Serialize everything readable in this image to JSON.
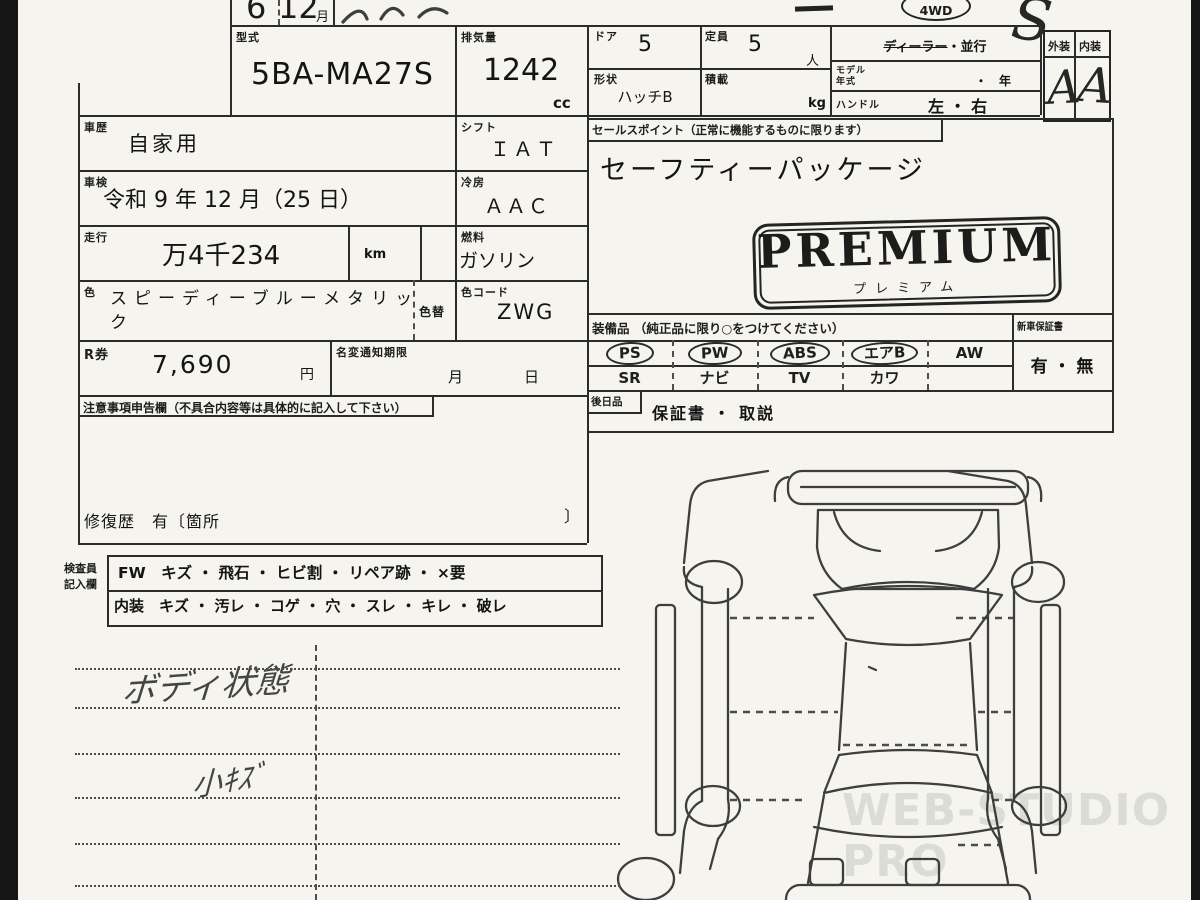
{
  "watermark": "WEB-STUDIO PRO",
  "top_row": {
    "month_num_1": "6",
    "month_num_2": "12",
    "month_unit": "月",
    "drive_type": "4WD",
    "handwritten_grade": "S"
  },
  "header": {
    "model_code": {
      "label": "型式",
      "value": "5BA-MA27S"
    },
    "displacement": {
      "label": "排気量",
      "value": "1242",
      "unit": "cc"
    },
    "doors": {
      "label": "ドア",
      "value": "5"
    },
    "body_shape": {
      "label": "形状",
      "value": "ハッチB"
    },
    "capacity": {
      "label": "定員",
      "value": "5",
      "unit": "人"
    },
    "load": {
      "label": "積載",
      "unit": "kg"
    },
    "dealer_parallel": {
      "option_1": "ディーラー",
      "separator": "・",
      "option_2": "並行"
    },
    "model_year": {
      "label_line1": "モデル",
      "label_line2": "年式",
      "suffix": "・　年"
    },
    "steering": {
      "label": "ハンドル",
      "value": "左 ・ 右"
    },
    "exterior": {
      "label": "外装",
      "grade": "A"
    },
    "interior": {
      "label": "内装",
      "grade": "A"
    }
  },
  "details": {
    "history": {
      "label": "車歴",
      "value": "自家用"
    },
    "shift": {
      "label": "シフト",
      "value": "ＩＡＴ"
    },
    "inspection": {
      "label": "車検",
      "value": "令和 9 年 12 月（25 日）"
    },
    "aircon": {
      "label": "冷房",
      "value": "ＡＡＣ"
    },
    "mileage": {
      "label": "走行",
      "value": "万4千234",
      "unit": "km"
    },
    "fuel": {
      "label": "燃料",
      "value": "ガソリン"
    },
    "color": {
      "label": "色",
      "value": "スピーディーブルーメタリック"
    },
    "color_change": {
      "label": "色替"
    },
    "color_code": {
      "label": "色コード",
      "value": "ZWG"
    },
    "r_ticket": {
      "label": "R券",
      "value": "7,690",
      "unit": "円"
    },
    "name_change_deadline": {
      "label": "名変通知期限",
      "value": "月　　　日"
    },
    "notice": {
      "label": "注意事項申告欄（不具合内容等は具体的に記入して下さい）"
    },
    "repair_history": {
      "text": "修復歴　有〔箇所",
      "bracket": "〕"
    },
    "inspector_box": {
      "label_line1": "検査員",
      "label_line2": "記入欄",
      "fw_row": "FW　キズ ・ 飛石 ・ ヒビ割 ・ リペア跡 ・ ×要",
      "interior_row": "内装　キズ ・ 汚レ ・ コゲ ・ 穴 ・ スレ ・ キレ ・ 破レ"
    },
    "handwritten_notes": [
      {
        "text": "ボディ状態"
      },
      {
        "text": "小ｷｽﾞ"
      }
    ]
  },
  "sales": {
    "sales_point": {
      "label": "セールスポイント（正常に機能するものに限ります）",
      "value": "セーフティーパッケージ"
    },
    "stamp": {
      "title": "PREMIUM",
      "subtitle": "プレミアム"
    },
    "equipment": {
      "label": "装備品 （純正品に限り○をつけてください）",
      "row1": [
        {
          "label": "PS",
          "circled": true
        },
        {
          "label": "PW",
          "circled": true
        },
        {
          "label": "ABS",
          "circled": true
        },
        {
          "label": "エアB",
          "circled": true
        },
        {
          "label": "AW",
          "circled": false
        }
      ],
      "row2": [
        {
          "label": "SR",
          "circled": false
        },
        {
          "label": "ナビ",
          "circled": false
        },
        {
          "label": "TV",
          "circled": false
        },
        {
          "label": "カワ",
          "circled": false
        },
        {
          "label": "",
          "circled": false
        }
      ],
      "warranty": {
        "label": "新車保証書",
        "value": "有 ・ 無"
      }
    },
    "later_items": {
      "label": "後日品",
      "value": "保証書 ・ 取説"
    }
  },
  "colors": {
    "paper": "#f5f4ef",
    "ink": "#2b2b2b",
    "edge_band": "#161616",
    "watermark": "#d8d8d2"
  }
}
